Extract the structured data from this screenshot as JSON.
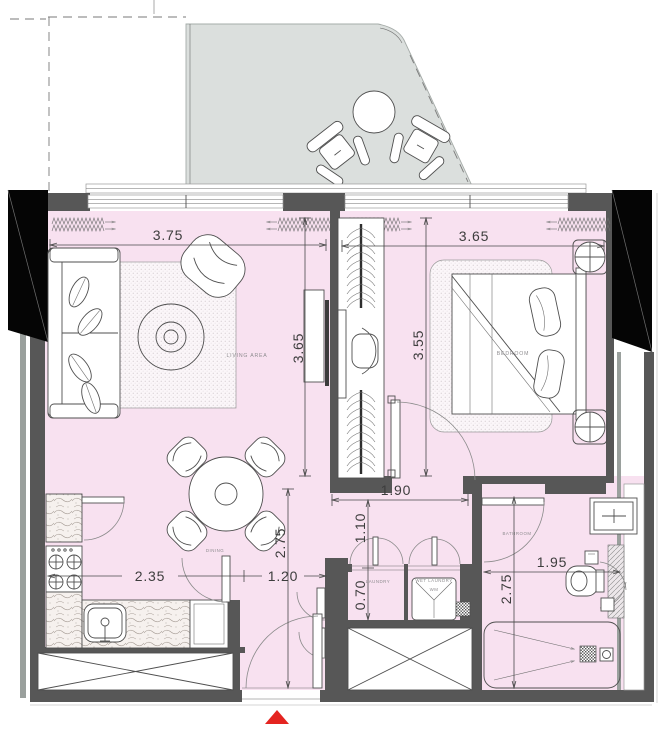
{
  "plan": {
    "rooms": {
      "living": {
        "label": "LIVING AREA"
      },
      "bedroom": {
        "label": "BEDROOM"
      },
      "dining": {
        "label": "DINING"
      },
      "laundry": {
        "label": "LAUNDRY"
      },
      "wet_laundry": {
        "label": "WET LAUNDRY",
        "sub": "WM"
      },
      "bathroom": {
        "label": "BATHROOM"
      }
    },
    "dimensions": {
      "living_width": "3.75",
      "living_depth": "3.65",
      "bedroom_width": "3.65",
      "wardrobe_depth": "3.55",
      "hall_width": "1.90",
      "hall_depth": "1.10",
      "laundry_depth": "0.70",
      "dining_depth": "2.75",
      "kitchen_width": "2.35",
      "entry_width": "1.20",
      "bathroom_width": "1.95",
      "bathroom_depth": "2.75"
    },
    "colors": {
      "floor_pink": "#f8e1f0",
      "terrace_gray": "#dbdfdd",
      "wall_dark": "#575757",
      "structure_black": "#050505",
      "entry_marker_red": "#e42420"
    },
    "markers": {
      "entry": "entry-arrow"
    }
  }
}
